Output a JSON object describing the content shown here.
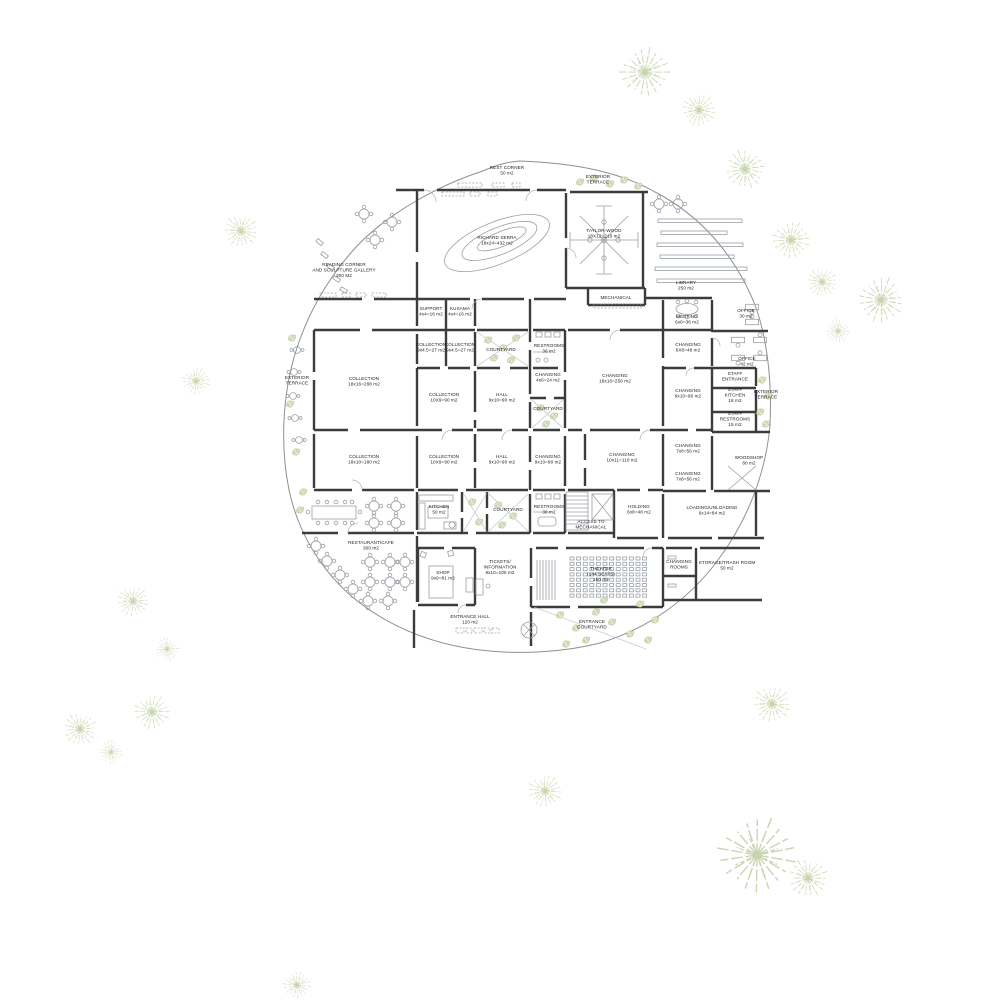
{
  "plan": {
    "type": "architectural-floor-plan",
    "building": "museum ground floor",
    "accent_green": "#c9d4ae",
    "wall_color": "#3c3c3c"
  },
  "labels": {
    "rest_corner": {
      "x": 507,
      "y": 169,
      "lines": [
        "REST CORNER",
        "50 m2"
      ]
    },
    "ext_terrace_top": {
      "x": 598,
      "y": 178,
      "lines": [
        "EXTERIOR",
        "TERRACE"
      ]
    },
    "richard_serra": {
      "x": 497,
      "y": 239,
      "lines": [
        "RICHARD SERRA",
        "18x24=432 m2"
      ]
    },
    "taylor_wood": {
      "x": 604,
      "y": 232,
      "lines": [
        "TAYLOR-WOOD",
        "18X12=216 m2"
      ]
    },
    "library": {
      "x": 686,
      "y": 284,
      "lines": [
        "LIBRARY",
        "250 m2"
      ]
    },
    "reading_corner": {
      "x": 344,
      "y": 266,
      "anchor": "start",
      "lines": [
        "READING CORNER",
        "AND SCULPTURE GALLERY",
        "300 M2"
      ]
    },
    "mechanical": {
      "x": 616,
      "y": 299,
      "lines": [
        "MECHANICAL"
      ]
    },
    "support": {
      "x": 431,
      "y": 310,
      "lines": [
        "SUPPORT",
        "4x4=16 m2"
      ]
    },
    "kusama": {
      "x": 460,
      "y": 310,
      "lines": [
        "KUSAMA",
        "4x4=16 m2"
      ]
    },
    "meeting": {
      "x": 687,
      "y": 318,
      "lines": [
        "MEETING",
        "6x6=36 m2"
      ]
    },
    "office_30": {
      "x": 746,
      "y": 312,
      "lines": [
        "OFFICE",
        "30 m2"
      ]
    },
    "collection_27_a": {
      "x": 431,
      "y": 346,
      "lines": [
        "COLLECTION",
        "9x4.5=27 m2"
      ]
    },
    "collection_27_b": {
      "x": 460,
      "y": 346,
      "lines": [
        "COLLECTION",
        "9x4.5=27 m2"
      ]
    },
    "courtyard_a": {
      "x": 501,
      "y": 351,
      "lines": [
        "COURTYARD"
      ]
    },
    "restrooms_top": {
      "x": 549,
      "y": 347,
      "lines": [
        "RESTROOMS",
        "36 m2"
      ]
    },
    "changing_48": {
      "x": 688,
      "y": 346,
      "lines": [
        "CHANGING",
        "6X8=48 m2"
      ]
    },
    "office_42": {
      "x": 747,
      "y": 360,
      "lines": [
        "OFFICE",
        "42 m2"
      ]
    },
    "collection_288": {
      "x": 364,
      "y": 380,
      "lines": [
        "COLLECTION",
        "18x16=288 m2"
      ]
    },
    "ext_terrace_left": {
      "x": 297,
      "y": 379,
      "lines": [
        "EXTERIOR",
        "TERRACE"
      ]
    },
    "changing_24": {
      "x": 548,
      "y": 376,
      "lines": [
        "CHANGING",
        "4x6=24 m2"
      ]
    },
    "changing_256": {
      "x": 615,
      "y": 377,
      "lines": [
        "CHANGING",
        "16x16=256 m2"
      ]
    },
    "changing_90_a": {
      "x": 688,
      "y": 392,
      "lines": [
        "CHANGING",
        "9x10=90 m2"
      ]
    },
    "collection_90_a": {
      "x": 444,
      "y": 396,
      "lines": [
        "COLLECTION",
        "10X9=90 m2"
      ]
    },
    "hall_90_a": {
      "x": 502,
      "y": 396,
      "lines": [
        "HALL",
        "9x10=90 m2"
      ]
    },
    "staff_entrance": {
      "x": 735,
      "y": 375,
      "lines": [
        "STAFF",
        "ENTRANCE"
      ]
    },
    "staff_kitchen": {
      "x": 735,
      "y": 391,
      "lines": [
        "STAFF",
        "KITCHEN",
        "18 m2"
      ]
    },
    "staff_restrooms": {
      "x": 735,
      "y": 415,
      "lines": [
        "STAFF",
        "RESTROOMS",
        "15 m2"
      ]
    },
    "ext_terrace_right": {
      "x": 766,
      "y": 393,
      "lines": [
        "EXTERIOR",
        "TERRACE"
      ]
    },
    "courtyard_b": {
      "x": 548,
      "y": 410,
      "lines": [
        "COURTYARD"
      ]
    },
    "collection_180": {
      "x": 364,
      "y": 458,
      "lines": [
        "COLLECTION",
        "18x10=180 m2"
      ]
    },
    "collection_90_b": {
      "x": 444,
      "y": 458,
      "lines": [
        "COLLECTION",
        "10X9=90 m2"
      ]
    },
    "hall_90_b": {
      "x": 502,
      "y": 458,
      "lines": [
        "HALL",
        "9x10=90 m2"
      ]
    },
    "changing_90_b": {
      "x": 548,
      "y": 458,
      "lines": [
        "CHANGING",
        "9x10=90 m2"
      ]
    },
    "changing_110": {
      "x": 622,
      "y": 456,
      "lines": [
        "CHANGING",
        "10x11=110 m2"
      ]
    },
    "changing_56_a": {
      "x": 688,
      "y": 447,
      "lines": [
        "CHANGING",
        "7x8=56 m2"
      ]
    },
    "woodshop": {
      "x": 749,
      "y": 459,
      "lines": [
        "WOODSHOP",
        "80 m2"
      ]
    },
    "changing_56_b": {
      "x": 688,
      "y": 475,
      "lines": [
        "CHANGING",
        "7x8=56 m2"
      ]
    },
    "kitchen": {
      "x": 439,
      "y": 508,
      "lines": [
        "KITCHEN",
        "50 m2"
      ]
    },
    "courtyard_c": {
      "x": 508,
      "y": 511,
      "lines": [
        "COURTYARD"
      ]
    },
    "restrooms_bottom": {
      "x": 549,
      "y": 508,
      "lines": [
        "RESTROOMS",
        "36 m2"
      ]
    },
    "access_mechanical": {
      "x": 591,
      "y": 523,
      "lines": [
        "ACCESS TO",
        "MECHANICAL"
      ]
    },
    "holding": {
      "x": 639,
      "y": 508,
      "lines": [
        "HOLDING",
        "6x8=48 m2"
      ]
    },
    "loading": {
      "x": 712,
      "y": 509,
      "lines": [
        "LOADING/UNLOADING",
        "6x14=84 m2"
      ]
    },
    "restaurant": {
      "x": 371,
      "y": 544,
      "lines": [
        "RESTAURANT/CAFE",
        "300 m2"
      ]
    },
    "shop": {
      "x": 443,
      "y": 574,
      "lines": [
        "SHOP",
        "9x9=81 m2"
      ]
    },
    "tickets": {
      "x": 500,
      "y": 563,
      "lines": [
        "TICKETS/",
        "INFORMATION",
        "9x10=100 m2"
      ]
    },
    "theater": {
      "x": 601,
      "y": 570,
      "lines": [
        "THEATER",
        "(144 SEATS)",
        "150 m2"
      ]
    },
    "changing_rooms": {
      "x": 679,
      "y": 563,
      "lines": [
        "CHANGING",
        "ROOMS"
      ]
    },
    "storage_trash": {
      "x": 727,
      "y": 564,
      "lines": [
        "STORAGE/TRASH ROOM",
        "50 m2"
      ]
    },
    "entrance_hall": {
      "x": 470,
      "y": 618,
      "lines": [
        "ENTRANCE HALL",
        "120 m2"
      ]
    },
    "entrance_courtyard": {
      "x": 592,
      "y": 623,
      "lines": [
        "ENTRANCE",
        "COURTYARD"
      ]
    }
  }
}
